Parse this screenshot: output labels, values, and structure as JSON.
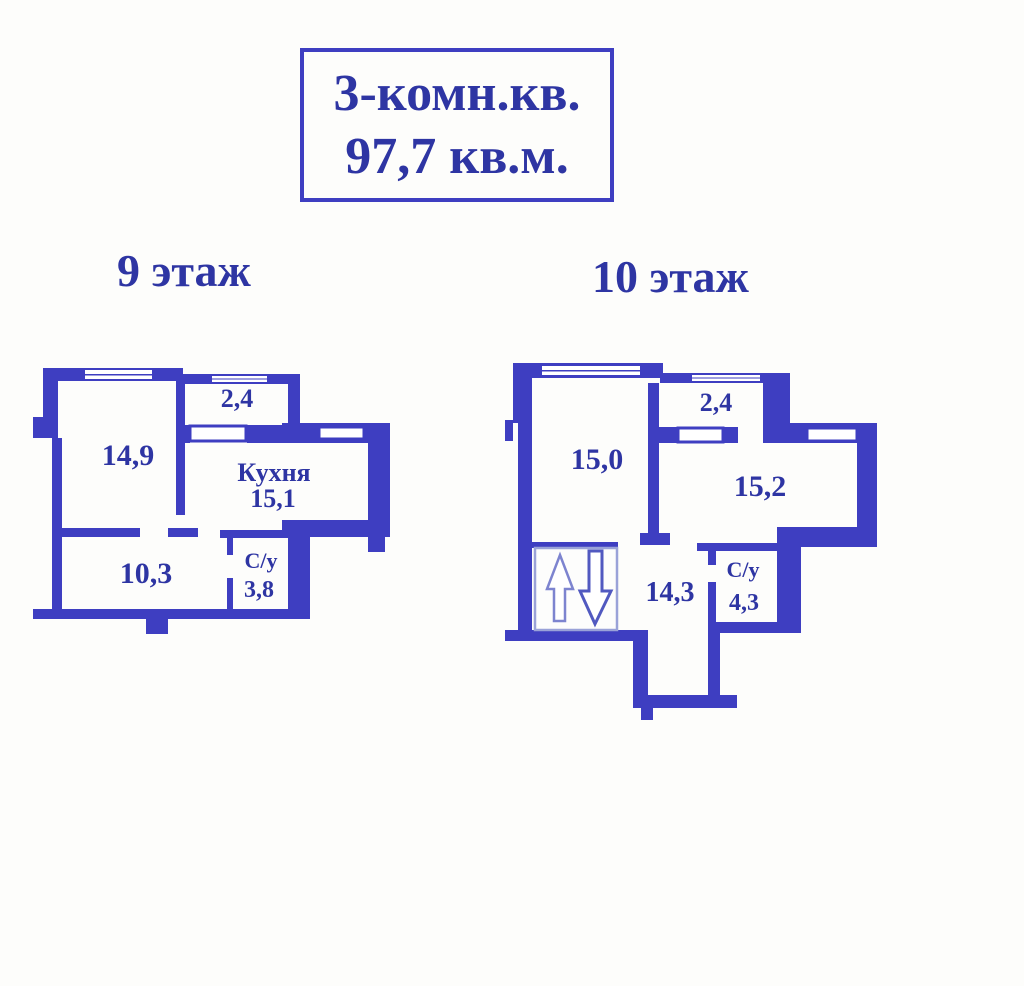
{
  "title": {
    "line1": "3-комн.кв.",
    "line2": "97,7 кв.м."
  },
  "floors": [
    {
      "label": "9 этаж",
      "rooms": {
        "room1_area": "14,9",
        "balcony_area": "2,4",
        "kitchen_name": "Кухня",
        "kitchen_area": "15,1",
        "hall_area": "10,3",
        "bath_name": "С/у",
        "bath_area": "3,8"
      }
    },
    {
      "label": "10 этаж",
      "rooms": {
        "room1_area": "15,0",
        "balcony_area": "2,4",
        "room2_area": "15,2",
        "hall_area": "14,3",
        "bath_name": "С/у",
        "bath_area": "4,3"
      }
    }
  ],
  "icons": {
    "stairs_up": "arrow-up-icon",
    "stairs_down": "arrow-down-icon"
  },
  "colors": {
    "wall": "#3e3ec1",
    "text": "#2e35a3",
    "background": "#fdfdfb",
    "stairBorder": "#9aa2d8",
    "arrowUp": "#7d84cf",
    "arrowDown": "#5159c0"
  }
}
